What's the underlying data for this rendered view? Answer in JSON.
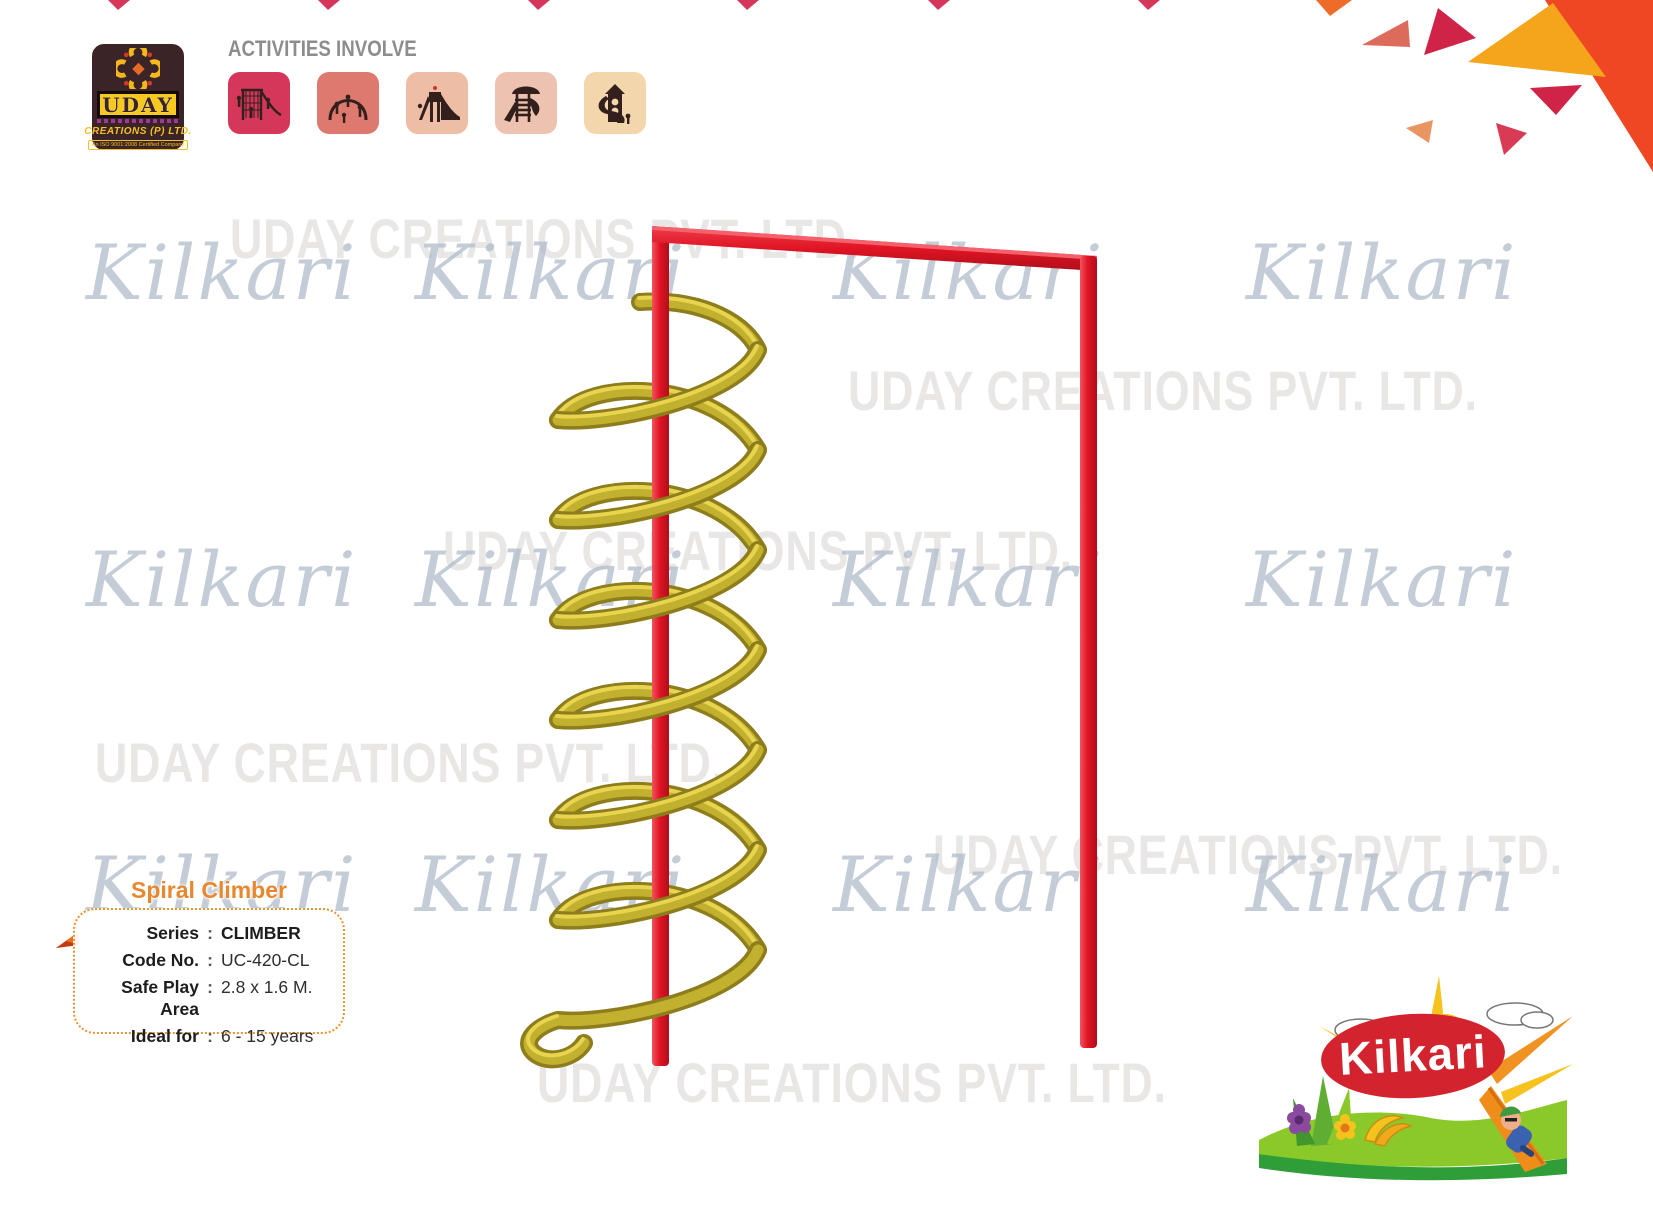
{
  "header": {
    "uday_logo": {
      "brand": "UDAY",
      "subtitle": "CREATIONS (P) LTD.",
      "certification": "An ISO 9001:2008 Certified Company"
    },
    "activities_label": "ACTIVITIES INVOLVE",
    "activity_icons": [
      {
        "name": "net-climber-icon",
        "tile_color": "#d5375a"
      },
      {
        "name": "arch-climber-icon",
        "tile_color": "#de7970"
      },
      {
        "name": "tower-slide-icon",
        "tile_color": "#edbda6"
      },
      {
        "name": "umbrella-tower-slide-icon",
        "tile_color": "#eec2b0"
      },
      {
        "name": "spiral-tower-slide-icon",
        "tile_color": "#f4d6ac"
      }
    ]
  },
  "watermarks": {
    "brand": "Kilkari",
    "company": "UDAY CREATIONS PVT. LTD."
  },
  "product": {
    "title": "Spiral Climber",
    "separator": ":",
    "specs": [
      {
        "label": "Series",
        "value": "CLIMBER"
      },
      {
        "label": "Code No.",
        "value": "UC-420-CL"
      },
      {
        "label": "Safe Play Area",
        "value": "2.8 x 1.6 M."
      },
      {
        "label": "Ideal for",
        "value": "6 - 15 years"
      }
    ]
  },
  "footer": {
    "kilkari_logo_text": "Kilkari"
  },
  "colors": {
    "frame_red": "#e01424",
    "spiral_yellow": "#c2b12e",
    "title_orange": "#e8872e",
    "spec_border_orange": "#e8962f",
    "watermark_company_gray": "#e9e6e6",
    "watermark_brand_blue": "#b0bcca",
    "corner_triangle_red": "#ef4723",
    "corner_triangle_yellow": "#f5a51b"
  }
}
